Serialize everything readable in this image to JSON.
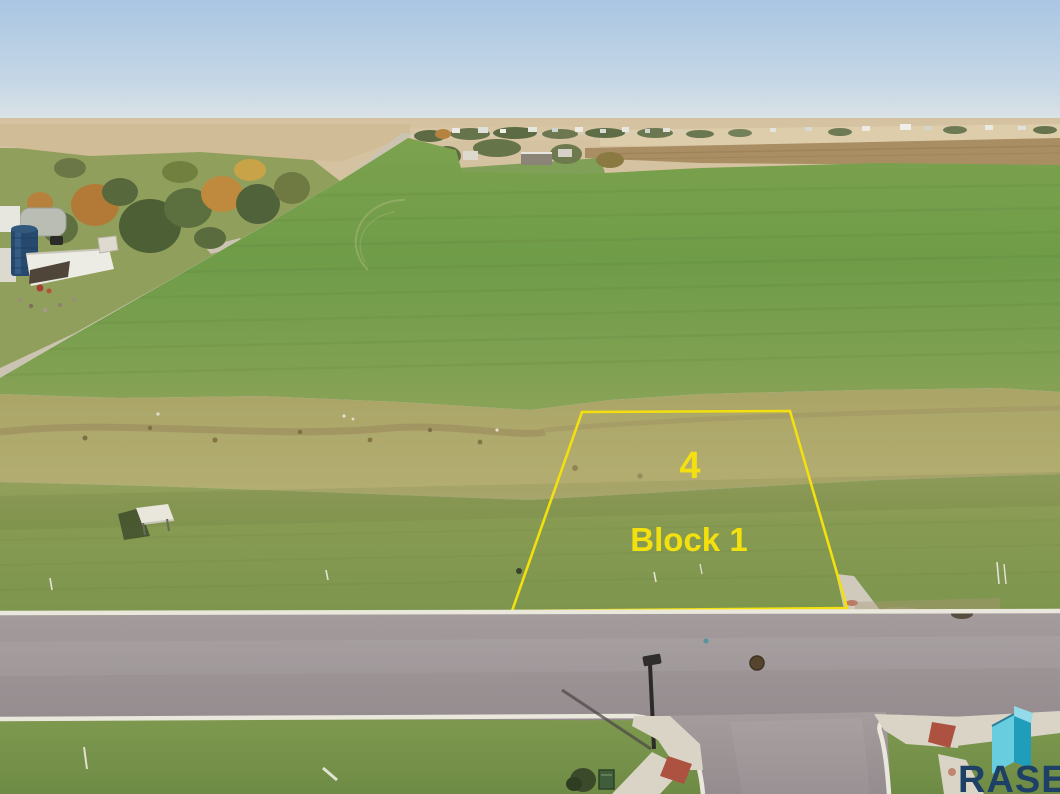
{
  "photo": {
    "description": "Aerial drone photo of a rural vacant lot outlined for sale"
  },
  "lot": {
    "number": "4",
    "block_label": "Block 1",
    "outline_color": "#F3E00E"
  },
  "branding": {
    "logo_text": "RASE",
    "logo_text_color": "#1E3F66",
    "icon": "rase-cube-icon",
    "icon_light": "#69CDE0",
    "icon_dark": "#209DBB"
  }
}
